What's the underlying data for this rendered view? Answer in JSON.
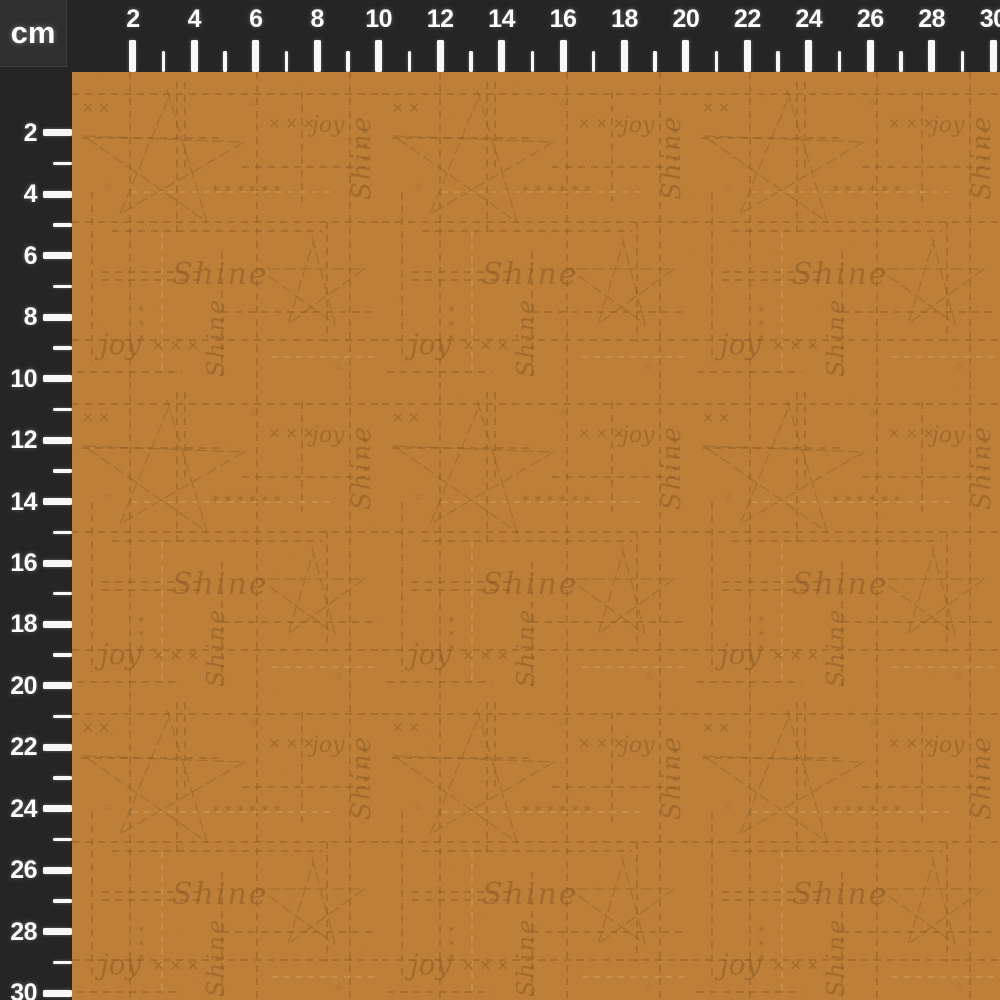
{
  "ruler": {
    "unit_label": "cm",
    "labels": [
      "2",
      "4",
      "6",
      "8",
      "10",
      "12",
      "14",
      "16",
      "18",
      "20",
      "22",
      "24",
      "26",
      "28",
      "30"
    ],
    "min_cm": 2,
    "max_cm": 30,
    "px_per_cm": 30.72,
    "origin_px": 71.5,
    "thickness_px": 72,
    "colors": {
      "strip_bg": "#252525",
      "corner_bg": "#2f2f2f",
      "tick": "#f7f7f7",
      "label": "#ffffff"
    }
  },
  "fabric": {
    "words": [
      "Shine",
      "joy"
    ],
    "symbols": {
      "x_row": "× × ×",
      "x_pair": "× ×",
      "asterisk_row": "* * *   * * *",
      "asterisk": "*",
      "tiny_star": "☆"
    },
    "colors": {
      "base": "#c08138",
      "mark": "#8a5a22",
      "light_mark": "#d4a766"
    }
  }
}
